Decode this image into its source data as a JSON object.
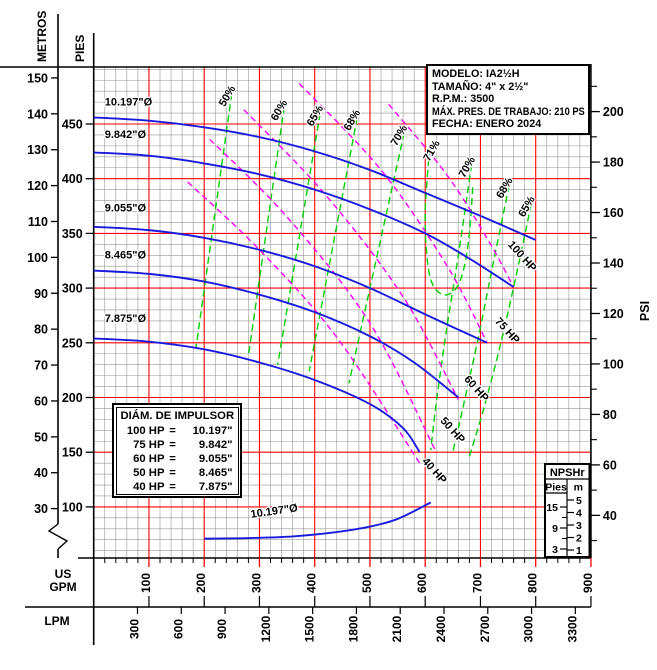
{
  "title_box": {
    "modelo": "MODELO: IA2½H",
    "tamano": "TAMAÑO: 4\" x 2½\"",
    "rpm": "R.P.M.: 3500",
    "max_pres": "MÁX. PRES. DE TRABAJO: 210 PS",
    "fecha": "FECHA: ENERO 2024"
  },
  "legend_box": {
    "title": "DIÁM. DE IMPULSOR",
    "rows": [
      {
        "hp": "100 HP",
        "eq": "=",
        "dia": "10.197\""
      },
      {
        "hp": "75 HP",
        "eq": "=",
        "dia": "9.842\""
      },
      {
        "hp": "60 HP",
        "eq": "=",
        "dia": "9.055\""
      },
      {
        "hp": "50 HP",
        "eq": "=",
        "dia": "8.465\""
      },
      {
        "hp": "40 HP",
        "eq": "=",
        "dia": "7.875\""
      }
    ]
  },
  "npsh_box": {
    "title": "NPSHr",
    "col_left": "Pies",
    "col_right": "m",
    "m_ticks": [
      5,
      4,
      3,
      2,
      1
    ],
    "pies_labeled_ticks": [
      15,
      9,
      3
    ],
    "pies_minor_ticks": [
      12,
      6
    ]
  },
  "chart_data": {
    "type": "line",
    "title": "Pump performance curve IA2½H 3500 RPM",
    "x_axis": {
      "primary_label": "US GPM",
      "secondary_label": "LPM",
      "gpm_range": [
        0,
        900
      ],
      "gpm_ticks": [
        100,
        200,
        300,
        400,
        500,
        600,
        700,
        800,
        900
      ],
      "gpm_minor_step": 20,
      "lpm_ticks": [
        300,
        600,
        900,
        1200,
        1500,
        1800,
        2100,
        2400,
        2700,
        3000,
        3300
      ]
    },
    "y_axis": {
      "left_primary_label": "METROS",
      "left_secondary_label": "PIES",
      "right_label": "PSI",
      "metros_ticks": [
        150,
        140,
        130,
        120,
        110,
        100,
        90,
        80,
        70,
        60,
        50,
        40,
        30
      ],
      "pies_ticks": [
        450,
        400,
        350,
        300,
        250,
        200,
        150,
        100
      ],
      "psi_ticks": [
        200,
        180,
        160,
        140,
        120,
        100,
        80,
        60,
        40
      ],
      "psi_minor_ticks": [
        210,
        190,
        170,
        150,
        130,
        110,
        90,
        70,
        50,
        30
      ],
      "red_line_pies": [
        450,
        400,
        350,
        300,
        250,
        200,
        150,
        100
      ],
      "pies_minor_step": 10,
      "grid": true
    },
    "head_curves": [
      {
        "name": "10.197\"Ø",
        "hp": "100 HP",
        "label_at": [
          20,
          467
        ],
        "points": [
          [
            0,
            456
          ],
          [
            100,
            453
          ],
          [
            200,
            447
          ],
          [
            300,
            438
          ],
          [
            400,
            425
          ],
          [
            500,
            408
          ],
          [
            600,
            387
          ],
          [
            700,
            366
          ],
          [
            800,
            344
          ]
        ]
      },
      {
        "name": "9.842\"Ø",
        "hp": "75 HP",
        "label_at": [
          20,
          437
        ],
        "points": [
          [
            0,
            424
          ],
          [
            100,
            421
          ],
          [
            200,
            414
          ],
          [
            300,
            404
          ],
          [
            400,
            390
          ],
          [
            500,
            372
          ],
          [
            600,
            350
          ],
          [
            680,
            327
          ],
          [
            760,
            301
          ]
        ]
      },
      {
        "name": "9.055\"Ø",
        "hp": "60 HP",
        "label_at": [
          20,
          370
        ],
        "points": [
          [
            0,
            356
          ],
          [
            100,
            353
          ],
          [
            200,
            346
          ],
          [
            300,
            335
          ],
          [
            400,
            320
          ],
          [
            500,
            300
          ],
          [
            600,
            276
          ],
          [
            712,
            250
          ]
        ]
      },
      {
        "name": "8.465\"Ø",
        "hp": "50 HP",
        "label_at": [
          20,
          327
        ],
        "points": [
          [
            0,
            316
          ],
          [
            100,
            313
          ],
          [
            200,
            306
          ],
          [
            300,
            294
          ],
          [
            400,
            278
          ],
          [
            500,
            256
          ],
          [
            580,
            232
          ],
          [
            660,
            200
          ]
        ]
      },
      {
        "name": "7.875\"Ø",
        "hp": "40 HP",
        "label_at": [
          20,
          269
        ],
        "points": [
          [
            0,
            254
          ],
          [
            100,
            251
          ],
          [
            200,
            244
          ],
          [
            300,
            232
          ],
          [
            400,
            216
          ],
          [
            500,
            194
          ],
          [
            560,
            172
          ],
          [
            590,
            150
          ]
        ]
      }
    ],
    "npsh_curve": {
      "name": "10.197\"Ø",
      "label_at": [
        285,
        90
      ],
      "label_rotation": -8,
      "points": [
        [
          200,
          71
        ],
        [
          280,
          71.5
        ],
        [
          360,
          73
        ],
        [
          440,
          77
        ],
        [
          500,
          82
        ],
        [
          550,
          89
        ],
        [
          610,
          104
        ]
      ]
    },
    "efficiency_lines": [
      {
        "label": "50%",
        "label_at": [
          247,
          474
        ],
        "points": [
          [
            250,
            478
          ],
          [
            185,
            245
          ]
        ]
      },
      {
        "label": "60%",
        "label_at": [
          341,
          461
        ],
        "points": [
          [
            345,
            466
          ],
          [
            280,
            238
          ]
        ]
      },
      {
        "label": "65%",
        "label_at": [
          406,
          456
        ],
        "points": [
          [
            410,
            460
          ],
          [
            333,
            230
          ]
        ]
      },
      {
        "label": "68%",
        "label_at": [
          473,
          452
        ],
        "points": [
          [
            477,
            456
          ],
          [
            390,
            224
          ]
        ]
      },
      {
        "label": "70%",
        "label_at": [
          558,
          438
        ],
        "points": [
          [
            562,
            442
          ],
          [
            462,
            213
          ]
        ]
      },
      {
        "label": "71%",
        "label_at": [
          617,
          424
        ],
        "points": [
          [
            608,
            428
          ],
          [
            600,
            370
          ],
          [
            603,
            330
          ],
          [
            612,
            305
          ],
          [
            632,
            294
          ],
          [
            655,
            299
          ],
          [
            670,
            318
          ],
          [
            680,
            350
          ],
          [
            686,
            392
          ]
        ]
      },
      {
        "label": "70%",
        "label_at": [
          681,
          409
        ],
        "points": [
          [
            684,
            413
          ],
          [
            660,
            330
          ],
          [
            638,
            260
          ],
          [
            620,
            195
          ],
          [
            610,
            152
          ]
        ]
      },
      {
        "label": "68%",
        "label_at": [
          749,
          390
        ],
        "points": [
          [
            752,
            394
          ],
          [
            722,
            320
          ],
          [
            695,
            252
          ],
          [
            668,
            190
          ],
          [
            650,
            150
          ]
        ]
      },
      {
        "label": "65%",
        "label_at": [
          789,
          373
        ],
        "points": [
          [
            792,
            377
          ],
          [
            764,
            310
          ],
          [
            736,
            248
          ],
          [
            706,
            190
          ],
          [
            678,
            143
          ]
        ]
      }
    ],
    "power_lines": [
      {
        "label": "40 HP",
        "label_at": [
          612,
          131
        ],
        "points": [
          [
            170,
            397
          ],
          [
            300,
            335
          ],
          [
            440,
            255
          ],
          [
            590,
            140
          ]
        ]
      },
      {
        "label": "50 HP",
        "label_at": [
          645,
          168
        ],
        "points": [
          [
            210,
            436
          ],
          [
            350,
            365
          ],
          [
            500,
            268
          ],
          [
            618,
            152
          ]
        ]
      },
      {
        "label": "60 HP",
        "label_at": [
          688,
          206
        ],
        "points": [
          [
            272,
            463
          ],
          [
            420,
            385
          ],
          [
            560,
            292
          ],
          [
            660,
            198
          ]
        ]
      },
      {
        "label": "75 HP",
        "label_at": [
          744,
          259
        ],
        "points": [
          [
            372,
            487
          ],
          [
            520,
            408
          ],
          [
            640,
            320
          ],
          [
            712,
            250
          ]
        ]
      },
      {
        "label": "100 HP",
        "label_at": [
          771,
          327
        ],
        "points": [
          [
            534,
            468
          ],
          [
            640,
            403
          ],
          [
            716,
            342
          ],
          [
            760,
            301
          ]
        ]
      }
    ],
    "colors": {
      "head_curve": "#1a1adf",
      "efficiency": "#00cf00",
      "power": "#ff00ff",
      "grid_major": "#ff0000",
      "grid_minor": "#999999",
      "axis": "#000000"
    }
  }
}
